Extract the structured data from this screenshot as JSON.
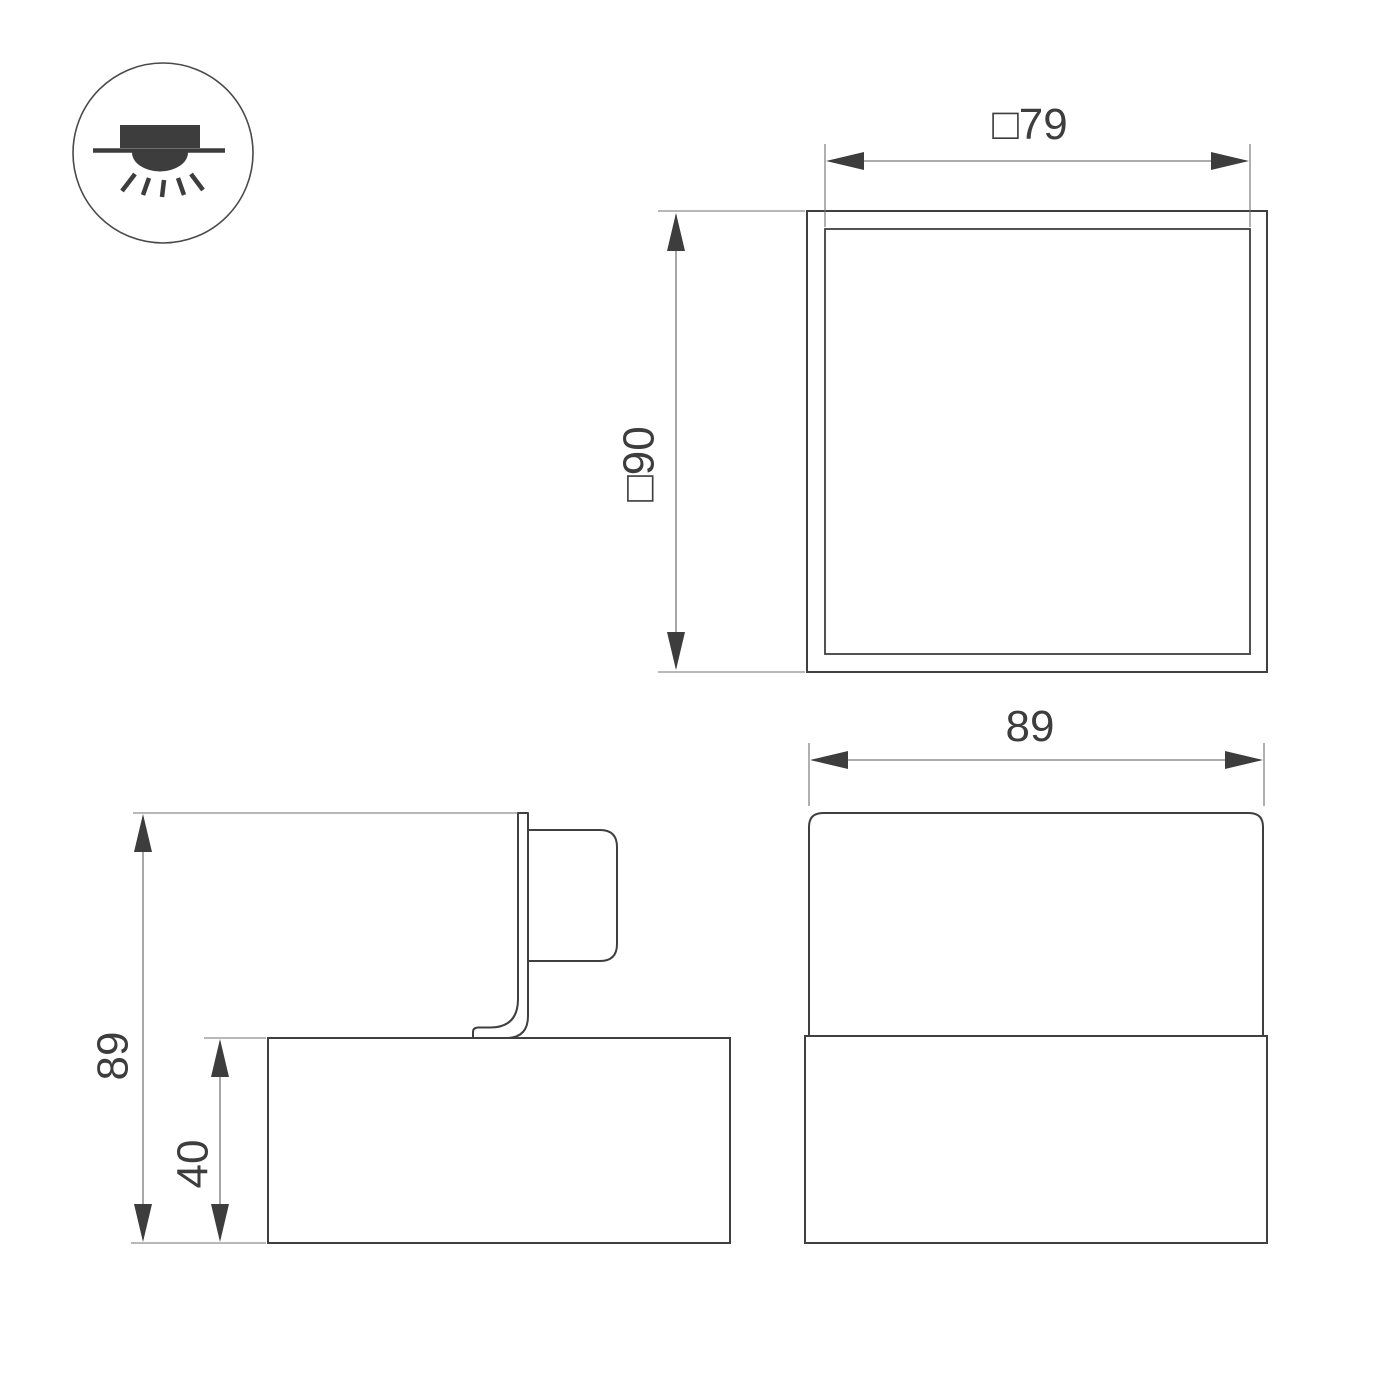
{
  "page": {
    "background": "#ffffff",
    "description": "Technical dimension drawing of a surface-mounted square downlight: plan view, side view with mounting bracket, front view, and mounting-type icon"
  },
  "palette": {
    "outline": "#3f3f3f",
    "dimension_line": "#7a7a7a",
    "extension_line": "#707070",
    "arrow_fill": "#3d3d3d",
    "text": "#3d3d3d",
    "icon_fill": "#3d3d3d"
  },
  "icon": {
    "name": "surface-mounted-downlight-icon",
    "meaning": "ceiling surface mount, light emitted downward"
  },
  "top_view": {
    "width_label": "□79",
    "height_label": "□90"
  },
  "side_view": {
    "overall_height_label": "89",
    "base_height_label": "40"
  },
  "front_view": {
    "width_label": "89"
  }
}
